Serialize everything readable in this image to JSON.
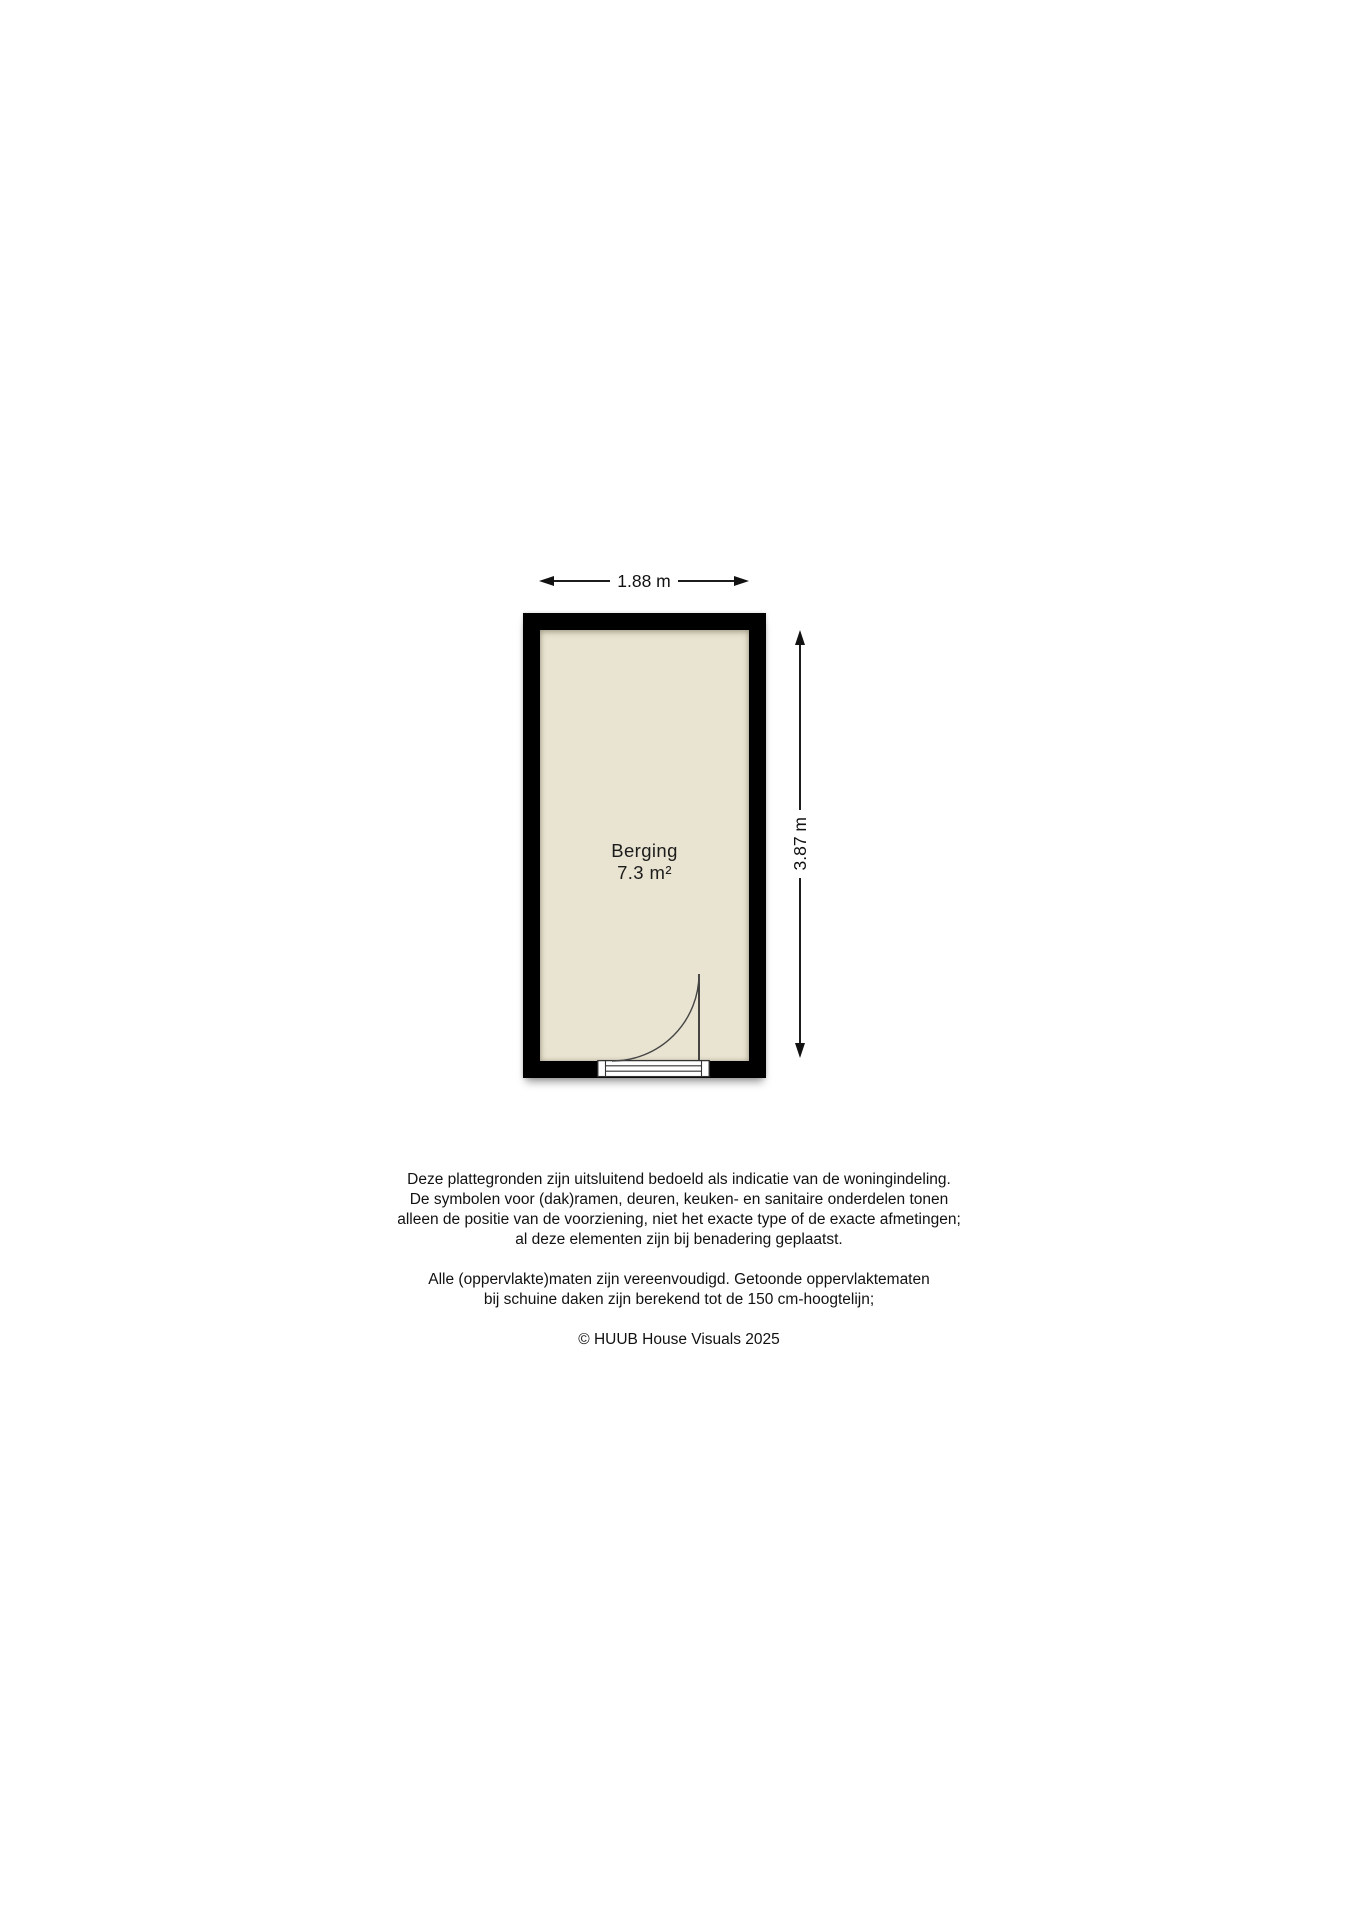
{
  "floorplan": {
    "width_label": "1.88 m",
    "height_label": "3.87 m",
    "room": {
      "name": "Berging",
      "area": "7.3 m²"
    },
    "colors": {
      "wall": "#000000",
      "floor": "#e9e4d1",
      "line": "#1c1c1c"
    },
    "icons": {
      "arrow_left_icon": "css-triangle-left",
      "arrow_right_icon": "css-triangle-right",
      "arrow_up_icon": "css-triangle-up",
      "arrow_down_icon": "css-triangle-down",
      "door_swing_icon": "quarter-circle-arc"
    }
  },
  "disclaimer": {
    "paragraphs": [
      {
        "lines": [
          "Deze plattegronden zijn uitsluitend bedoeld als indicatie van de woningindeling.",
          "De symbolen voor (dak)ramen, deuren, keuken- en sanitaire onderdelen tonen",
          "alleen de positie van de voorziening, niet het exacte type of de exacte afmetingen;",
          "al deze elementen zijn bij benadering geplaatst."
        ]
      },
      {
        "lines": [
          "Alle (oppervlakte)maten zijn vereenvoudigd. Getoonde oppervlaktematen",
          "bij schuine daken zijn berekend tot de 150 cm-hoogtelijn;"
        ]
      }
    ],
    "copyright": "© HUUB House Visuals 2025"
  }
}
